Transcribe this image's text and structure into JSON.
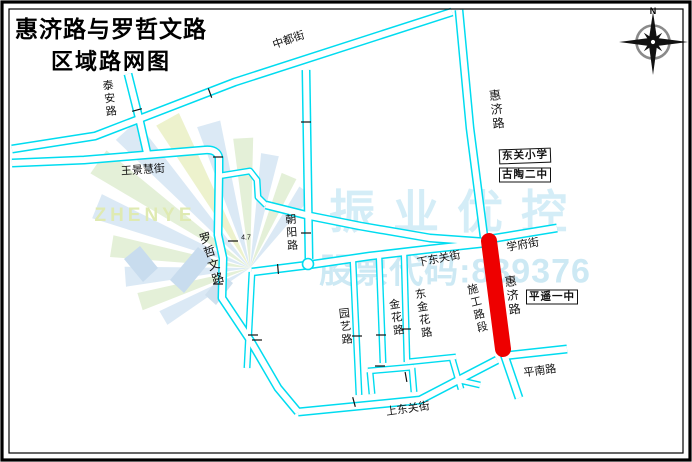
{
  "title": {
    "line1": "惠济路与罗哲文路",
    "line2": "区域路网图"
  },
  "compass": {
    "north": "N"
  },
  "road_labels": {
    "zhongdu": "中都街",
    "taian": "泰安路",
    "wangjinghui": "王景慧街",
    "luozhewen": "罗哲文路",
    "chaoyang": "朝阳路",
    "huiji": "惠济路",
    "xuefu": "学府街",
    "xiadongguan": "下东关街",
    "shigong": "施工路段",
    "yuanyi": "园艺路",
    "jinhua": "金花路",
    "dongjinhua": "东金花路",
    "shangdongguan": "上东关街",
    "pingnan": "平南路"
  },
  "poi_labels": {
    "dongguan_primary": "东关小学",
    "gutao_no2": "古陶二中",
    "pingyao_no1": "平遥一中"
  },
  "annotations": {
    "width_note": "4.7"
  },
  "watermark": {
    "brand_en": "ZHENYE",
    "brand_cn": "振业优控",
    "stock_code": "股票代码:839376"
  },
  "colors": {
    "road_line": "#00dcf0",
    "construction_segment": "#ee0000",
    "watermark_cyan": "#d4edf7",
    "watermark_green": "#dfeab2"
  }
}
